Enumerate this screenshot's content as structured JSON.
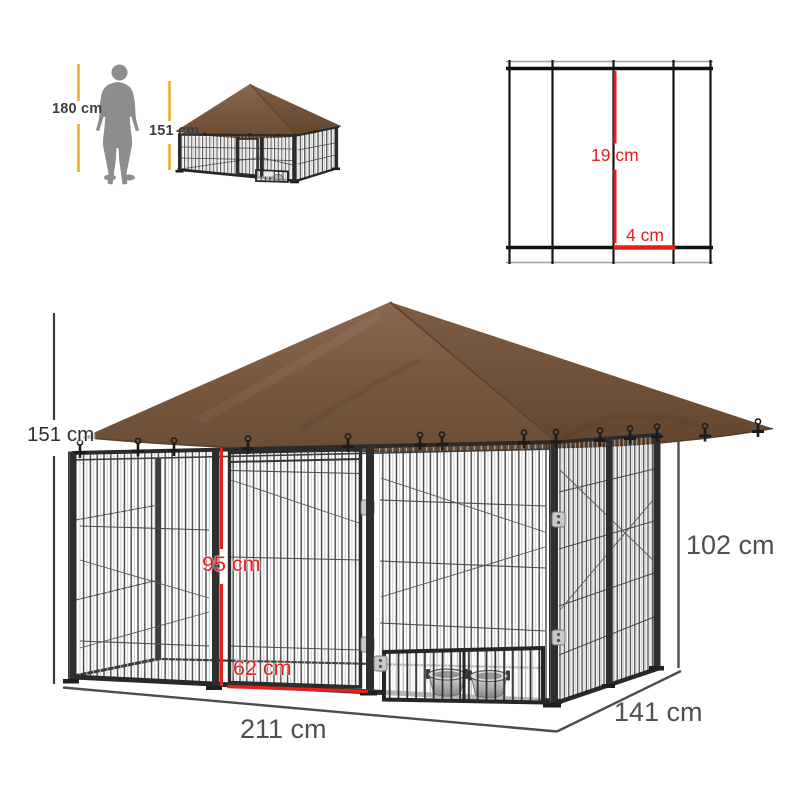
{
  "scale_reference": {
    "person_height": "180 cm",
    "kennel_height": "151 cm"
  },
  "mesh_detail": {
    "wire_vertical_gap": "19 cm",
    "wire_horizontal_gap": "4 cm"
  },
  "kennel_dimensions": {
    "total_height": "151 cm",
    "door_height": "95 cm",
    "door_width": "62 cm",
    "width": "211 cm",
    "depth": "141 cm",
    "panel_height": "102 cm"
  },
  "colors": {
    "accent_red": "#e2201c",
    "dimension_yellow": "#eab22c",
    "canopy_brown": "#7a5a41",
    "canopy_brown_dark": "#6e5038",
    "frame_black": "#2d2d2d",
    "dimension_gray": "#4d4d4d",
    "silhouette_gray": "#8d8d8d"
  }
}
